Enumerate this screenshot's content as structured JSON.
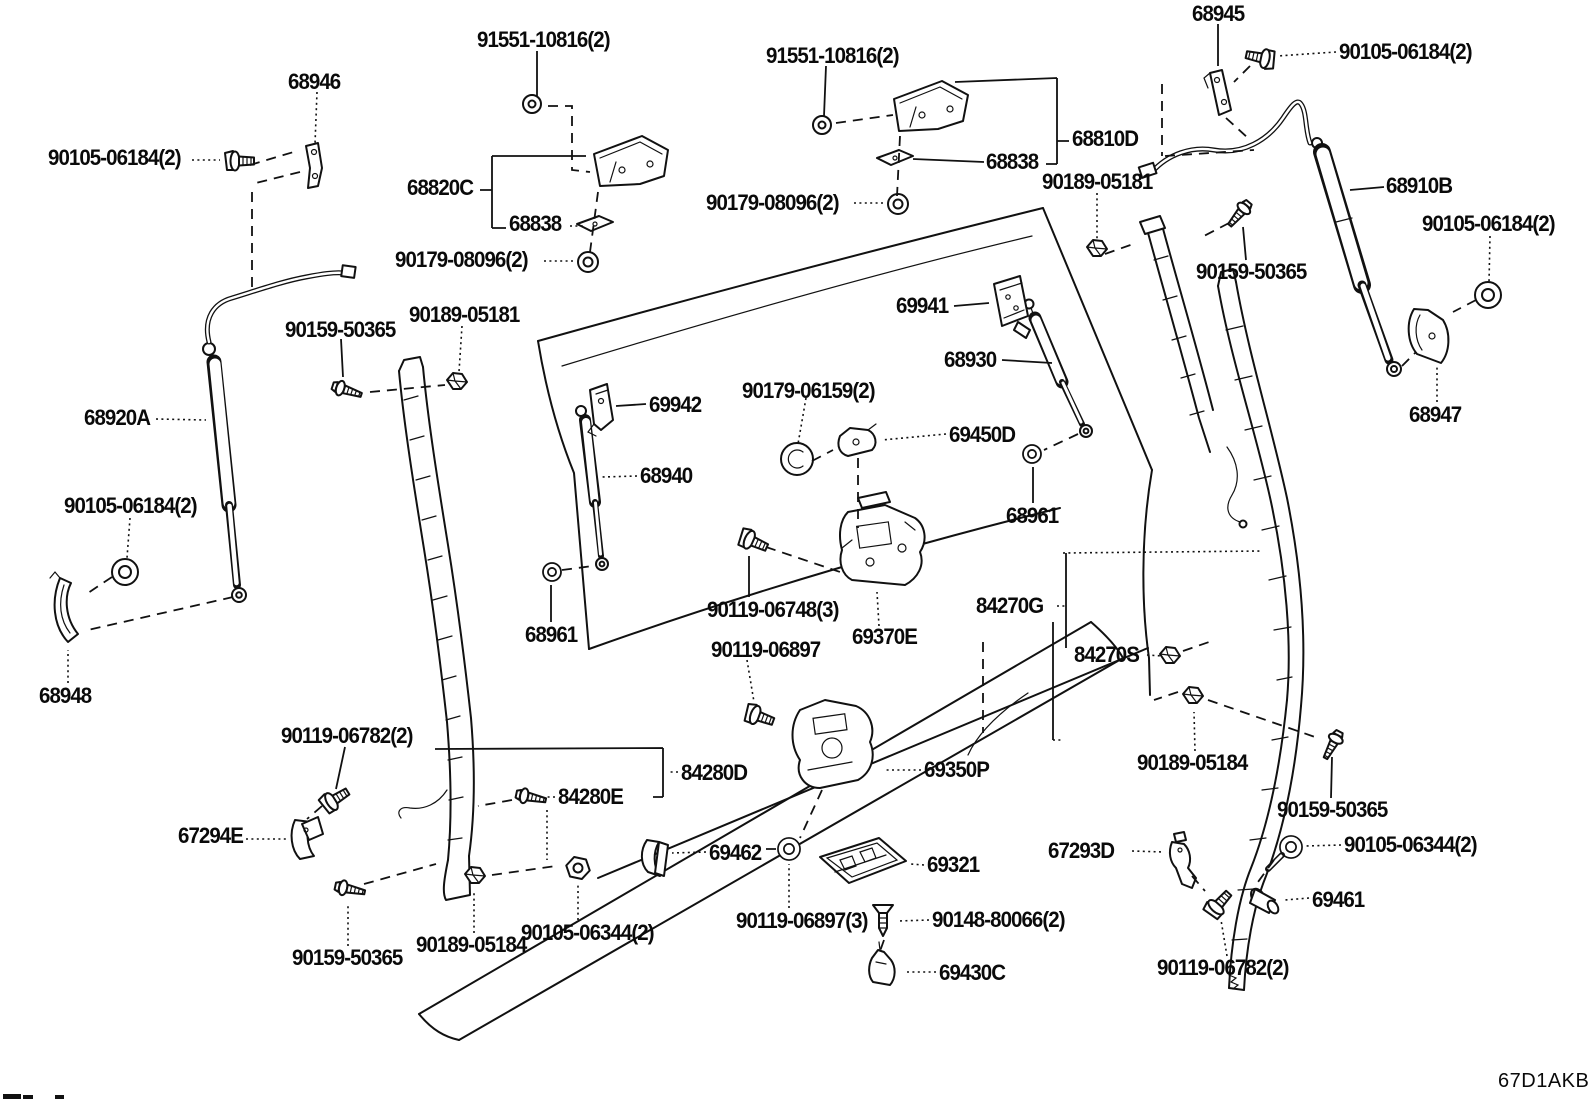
{
  "diagram": {
    "sheet_code": "67D1AKB",
    "background_color": "#ffffff",
    "line_color": "#111111",
    "description_labels_font": "bold condensed part numbers"
  },
  "part_labels": [
    {
      "text": "91551-10816(2)",
      "x": 477,
      "y": 29
    },
    {
      "text": "68946",
      "x": 288,
      "y": 71
    },
    {
      "text": "90105-06184(2)",
      "x": 48,
      "y": 147
    },
    {
      "text": "68820C",
      "x": 407,
      "y": 177
    },
    {
      "text": "68838",
      "x": 509,
      "y": 213
    },
    {
      "text": "90179-08096(2)",
      "x": 395,
      "y": 249
    },
    {
      "text": "91551-10816(2)",
      "x": 766,
      "y": 45
    },
    {
      "text": "68810D",
      "x": 1072,
      "y": 128
    },
    {
      "text": "68838",
      "x": 986,
      "y": 151
    },
    {
      "text": "90189-05181",
      "x": 1042,
      "y": 171
    },
    {
      "text": "90179-08096(2)",
      "x": 706,
      "y": 192
    },
    {
      "text": "68945",
      "x": 1192,
      "y": 3
    },
    {
      "text": "90105-06184(2)",
      "x": 1339,
      "y": 41
    },
    {
      "text": "68910B",
      "x": 1386,
      "y": 175
    },
    {
      "text": "90105-06184(2)",
      "x": 1422,
      "y": 213
    },
    {
      "text": "90159-50365",
      "x": 1196,
      "y": 261
    },
    {
      "text": "68947",
      "x": 1409,
      "y": 404
    },
    {
      "text": "90159-50365",
      "x": 285,
      "y": 319
    },
    {
      "text": "90189-05181",
      "x": 409,
      "y": 304
    },
    {
      "text": "68920A",
      "x": 84,
      "y": 407
    },
    {
      "text": "69942",
      "x": 649,
      "y": 394
    },
    {
      "text": "68940",
      "x": 640,
      "y": 465
    },
    {
      "text": "69941",
      "x": 896,
      "y": 295
    },
    {
      "text": "68930",
      "x": 944,
      "y": 349
    },
    {
      "text": "90179-06159(2)",
      "x": 742,
      "y": 380
    },
    {
      "text": "69450D",
      "x": 949,
      "y": 424
    },
    {
      "text": "68961",
      "x": 1006,
      "y": 505
    },
    {
      "text": "90105-06184(2)",
      "x": 64,
      "y": 495
    },
    {
      "text": "68961",
      "x": 525,
      "y": 624
    },
    {
      "text": "90119-06748(3)",
      "x": 707,
      "y": 599
    },
    {
      "text": "90119-06897",
      "x": 711,
      "y": 639
    },
    {
      "text": "69370E",
      "x": 852,
      "y": 626
    },
    {
      "text": "84270G",
      "x": 976,
      "y": 595
    },
    {
      "text": "84270S",
      "x": 1074,
      "y": 644
    },
    {
      "text": "68948",
      "x": 39,
      "y": 685
    },
    {
      "text": "90119-06782(2)",
      "x": 281,
      "y": 725
    },
    {
      "text": "84280D",
      "x": 681,
      "y": 762
    },
    {
      "text": "84280E",
      "x": 558,
      "y": 786
    },
    {
      "text": "69350P",
      "x": 924,
      "y": 759
    },
    {
      "text": "90189-05184",
      "x": 1137,
      "y": 752
    },
    {
      "text": "67294E",
      "x": 178,
      "y": 825
    },
    {
      "text": "90159-50365",
      "x": 1277,
      "y": 799
    },
    {
      "text": "90105-06344(2)",
      "x": 1344,
      "y": 834
    },
    {
      "text": "69461",
      "x": 1312,
      "y": 889
    },
    {
      "text": "67293D",
      "x": 1048,
      "y": 840
    },
    {
      "text": "69462",
      "x": 709,
      "y": 842
    },
    {
      "text": "69321",
      "x": 927,
      "y": 854
    },
    {
      "text": "90119-06897(3)",
      "x": 736,
      "y": 910
    },
    {
      "text": "90148-80066(2)",
      "x": 932,
      "y": 909
    },
    {
      "text": "69430C",
      "x": 939,
      "y": 962
    },
    {
      "text": "90159-50365",
      "x": 292,
      "y": 947
    },
    {
      "text": "90189-05184",
      "x": 416,
      "y": 934
    },
    {
      "text": "90105-06344(2)",
      "x": 521,
      "y": 922
    },
    {
      "text": "90119-06782(2)",
      "x": 1157,
      "y": 957
    }
  ]
}
